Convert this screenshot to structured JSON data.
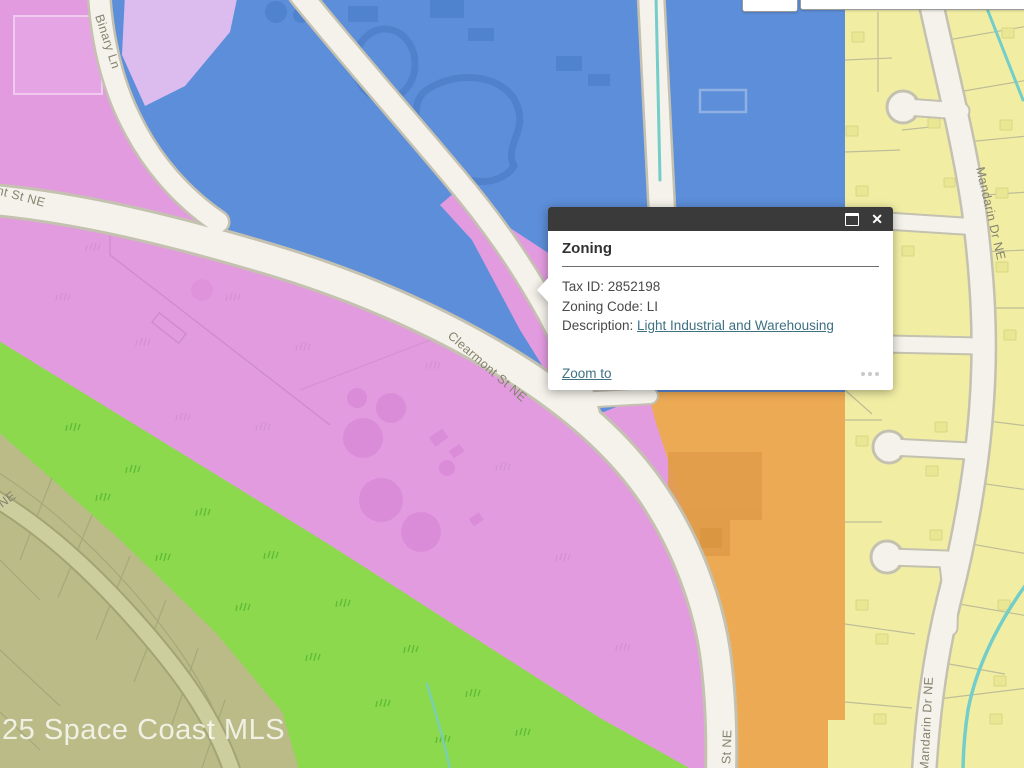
{
  "window": {
    "width": 1024,
    "height": 768
  },
  "map": {
    "labels": {
      "binary_ln": "Binary Ln",
      "clearmont_left": "nt St NE",
      "clearmont_mid": "Clearmont St NE",
      "clearmont_bottom": "t St NE",
      "mandarin_top": "Mandarin Dr NE",
      "mandarin_bottom": "Mandarin Dr NE",
      "olive_street_ne": "NE"
    },
    "watermark": "25 Space Coast MLS",
    "zone_colors": {
      "light_industrial_pink": "#e39be0",
      "institutional_blue": "#5d8ed9",
      "residential_yellow": "#f1eea4",
      "commercial_orange": "#edaa54",
      "recreation_green": "#8cd94e",
      "estate_olive": "#babb86",
      "lavender_wedge": "#dcbcee",
      "road_fill": "#f4f2ea",
      "road_casing": "#c4c1b0",
      "stream_teal": "#74cdc9"
    }
  },
  "popup": {
    "title": "Zoning",
    "tax_id": "Tax ID: 2852198",
    "zoning_code": "Zoning Code: LI",
    "description_label": "Description: ",
    "description_link": "Light Industrial and Warehousing",
    "zoom_to_label": "Zoom to",
    "header_color": "#3a3a3a",
    "link_color": "#3f7183",
    "icons": {
      "close": "✕",
      "maximize": "window-maximize",
      "menu": "ellipsis"
    }
  }
}
